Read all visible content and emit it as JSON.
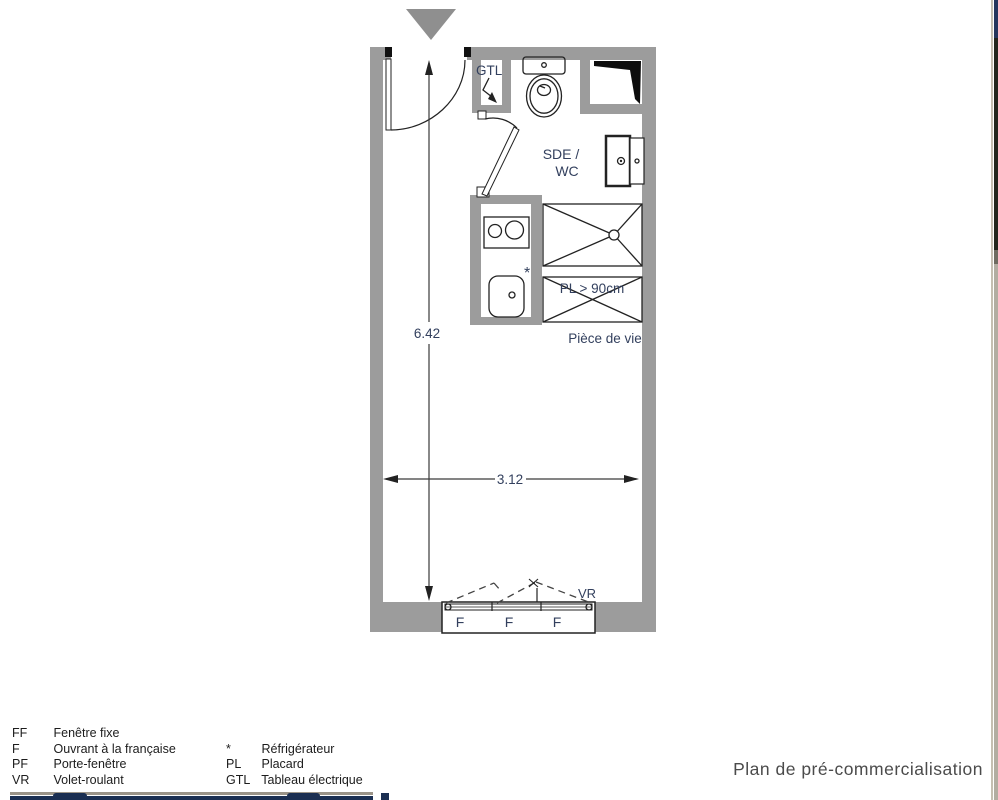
{
  "plan": {
    "labels": {
      "gtl": "GTL",
      "sde_wc_line1": "SDE /",
      "sde_wc_line2": "WC",
      "placard_size": "PL > 90cm",
      "piece_de_vie": "Pièce de vie",
      "vr": "VR",
      "fridge_symbol": "*",
      "window_panels": [
        "F",
        "F",
        "F"
      ]
    },
    "dimensions": {
      "height": "6.42",
      "width": "3.12"
    }
  },
  "legend": {
    "column1": [
      {
        "abbr": "FF",
        "label": "Fenêtre fixe"
      },
      {
        "abbr": "F",
        "label": "Ouvrant à la française"
      },
      {
        "abbr": "PF",
        "label": "Porte-fenêtre"
      },
      {
        "abbr": "VR",
        "label": "Volet-roulant"
      }
    ],
    "column2": [
      {
        "abbr": "*",
        "label": "Réfrigérateur"
      },
      {
        "abbr": "PL",
        "label": "Placard"
      },
      {
        "abbr": "GTL",
        "label": "Tableau électrique"
      }
    ]
  },
  "footer": {
    "title": "Plan de pré-commercialisation"
  },
  "colors": {
    "wall_gray": "#9c9c9c",
    "line_dark": "#222222",
    "plan_text_navy": "#33405e",
    "title_gray": "#4b4b4b",
    "accent_navy": "#1b2f52"
  }
}
